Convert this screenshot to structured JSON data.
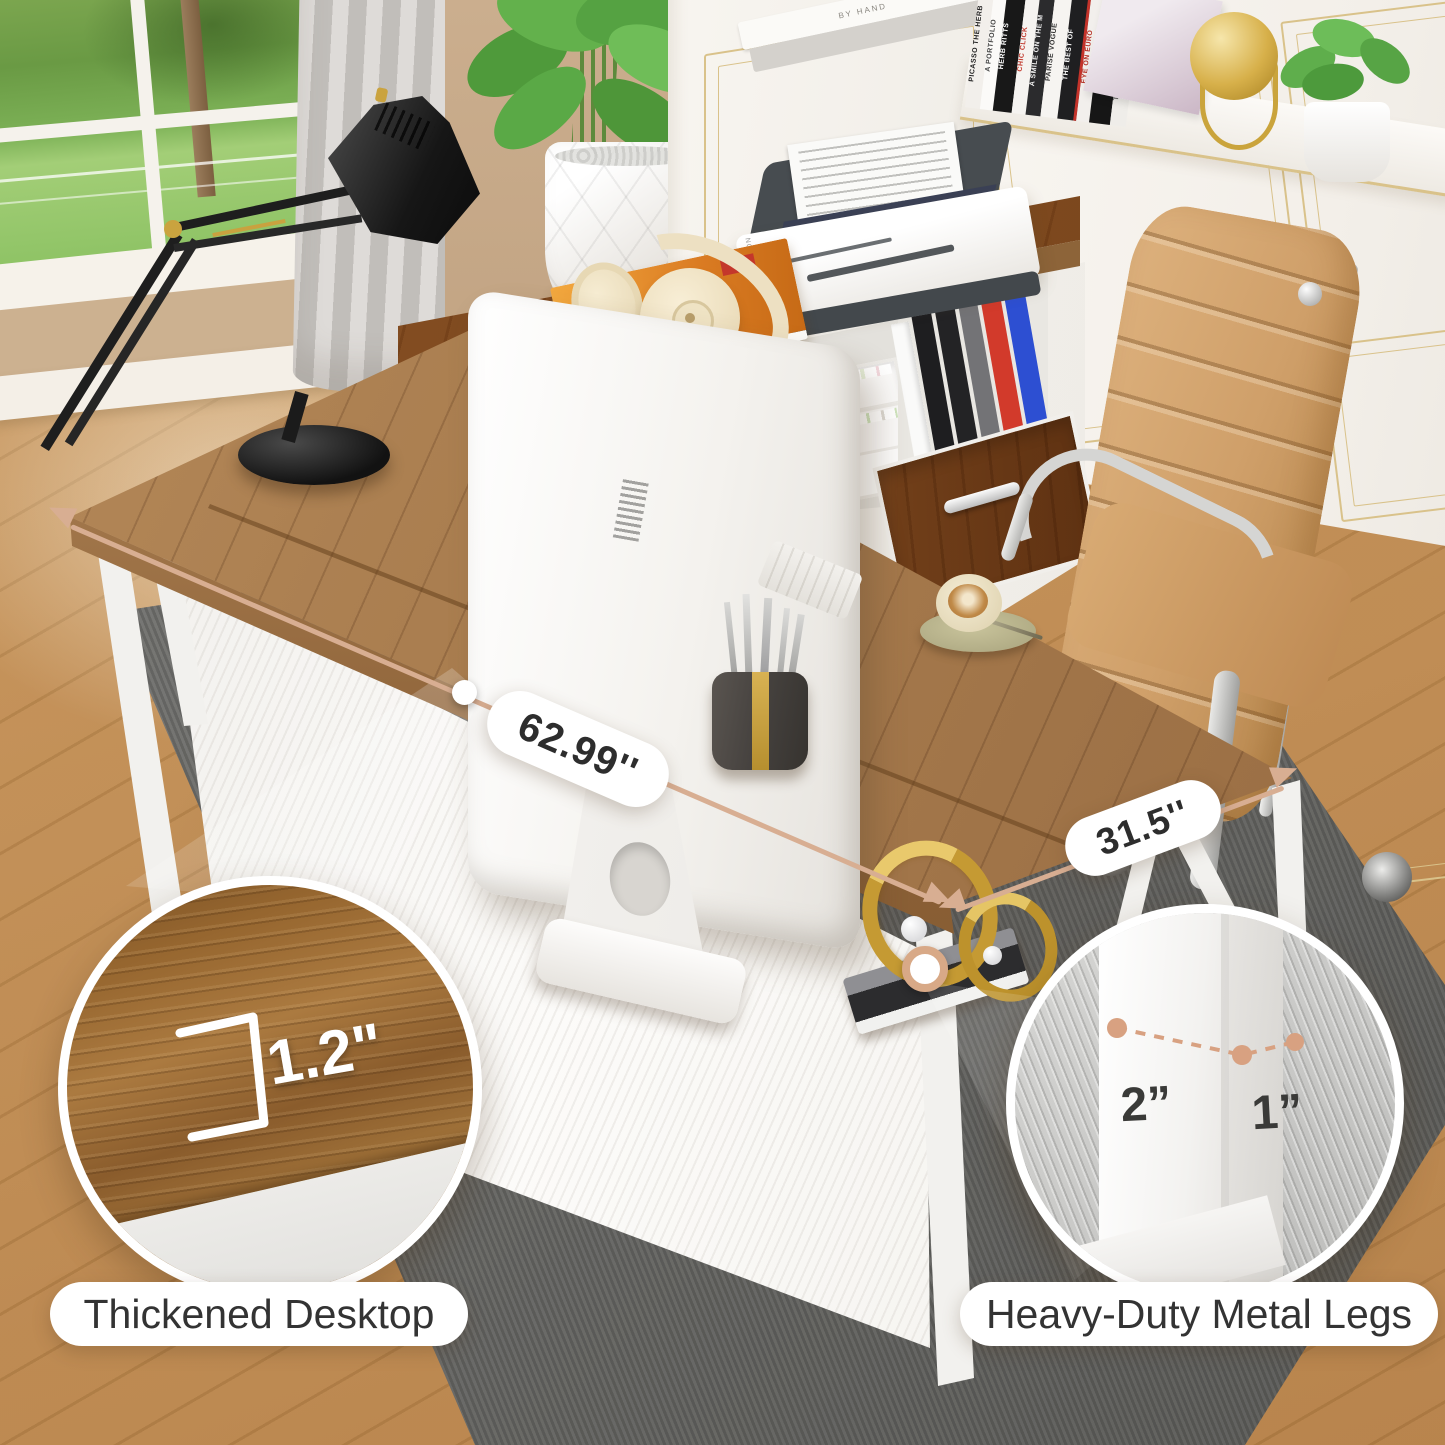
{
  "annotations": {
    "width_pill": "62.99''",
    "depth_pill": "31.5''",
    "thickness_value": "1.2\"",
    "leg_front_width": "2”",
    "leg_side_width": "1”",
    "callout_left": "Thickened Desktop",
    "callout_right": "Heavy-Duty Metal Legs"
  },
  "scene": {
    "printer_brand": "EPSON",
    "bookshelf": {
      "spines": [
        {
          "title": "PICASSO THE HERB"
        },
        {
          "title": "A PORTFOLIO"
        },
        {
          "title": "HERB RITTS"
        },
        {
          "title": "CHIC CLICK"
        },
        {
          "title": "A SMILE ON THE M"
        },
        {
          "title": "PARISE VOGUE"
        },
        {
          "title": "THE BEST OF"
        },
        {
          "title": "EYE ON EURO"
        },
        {
          "title": "VOGUE"
        },
        {
          "title": "THE WALKER STORY"
        }
      ],
      "flat_book": "BY HAND"
    }
  },
  "colors": {
    "accent_tan": "#D8AE92",
    "dash_tan": "#D8A181",
    "pill_text": "#2D2D2D",
    "desk_wood": "#A5794C",
    "metal_white": "#F2F1EE",
    "rug_gray": "#A9A9A7",
    "chair_leather": "#D2A06C",
    "gold_trim": "#D9C28A"
  }
}
